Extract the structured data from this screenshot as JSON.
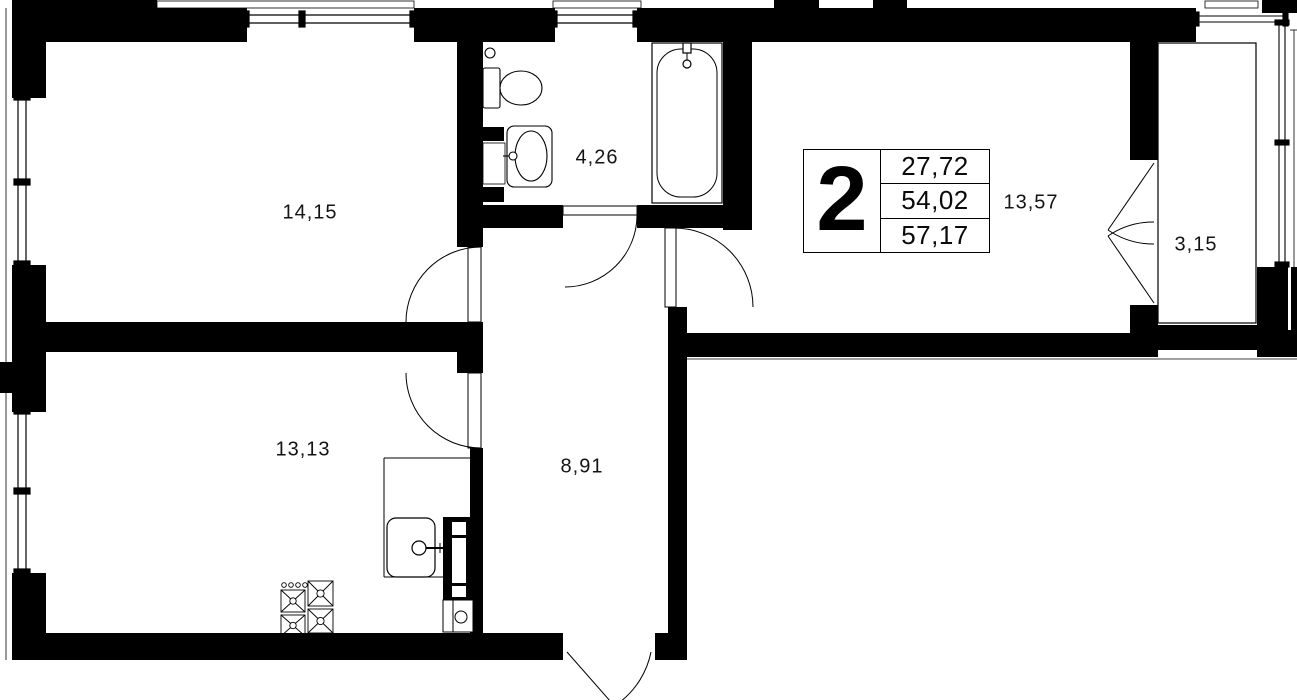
{
  "plan": {
    "type": "apartment-floor-plan",
    "unit": {
      "number": "2",
      "areas": [
        "27,72",
        "54,02",
        "57,17"
      ]
    },
    "rooms": [
      {
        "id": "room-1",
        "area": "14,15"
      },
      {
        "id": "bathroom",
        "area": "4,26"
      },
      {
        "id": "living-room",
        "area": "13,57"
      },
      {
        "id": "balcony",
        "area": "3,15"
      },
      {
        "id": "kitchen",
        "area": "13,13"
      },
      {
        "id": "hallway",
        "area": "8,91"
      }
    ],
    "fixtures": [
      "toilet-icon",
      "washbasin-icon",
      "bathtub-icon",
      "kitchen-sink-icon",
      "stove-icon",
      "vent-duct-icon"
    ],
    "colors": {
      "wall": "#000000",
      "background": "#ffffff"
    }
  }
}
